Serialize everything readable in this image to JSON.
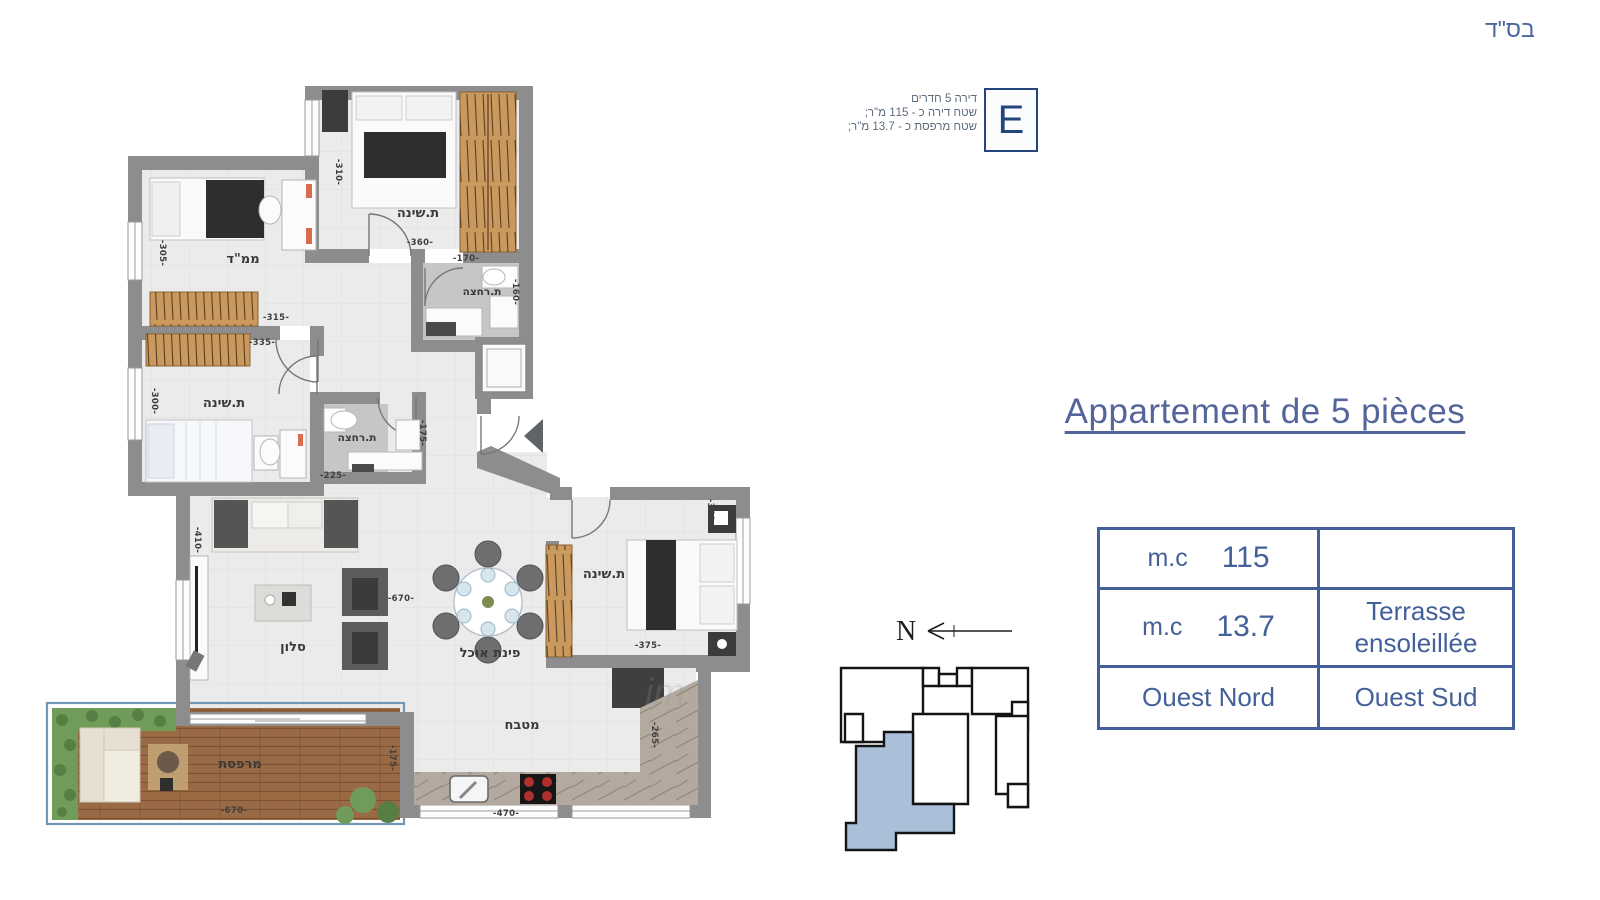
{
  "header": {
    "bsd": "בס\"ד"
  },
  "unit_info": {
    "letter": "E",
    "lines": [
      "דירה 5 חדרים",
      "שטח דירה כ - 115 מ\"ר;",
      "שטח מרפסת כ - 13.7 מ\"ר;"
    ]
  },
  "title": {
    "text": "Appartement de 5 pièces"
  },
  "spec_table": {
    "rows": [
      {
        "left": {
          "label": "m.c",
          "value": "115"
        },
        "right": ""
      },
      {
        "left": {
          "label": "m.c",
          "value": "13.7"
        },
        "right": "Terrasse ensoleillée"
      },
      {
        "left": {
          "label": "",
          "value": "Ouest Nord"
        },
        "right": "Ouest Sud"
      }
    ]
  },
  "compass": {
    "label": "N"
  },
  "watermark": "im",
  "colors": {
    "accent_blue": "#44609a",
    "deep_blue": "#25457d",
    "wall_gray": "#8d8d8d",
    "floor": "#ebebeb",
    "wood": "#c9995e",
    "deck": "#9a6a45",
    "hedge": "#6f9c58",
    "keyplan_highlight": "#a9c0d8",
    "dim_text": "#3f3f3f"
  },
  "floor_plan": {
    "room_labels": [
      {
        "text": "ת.שינה",
        "x": 418,
        "y": 217
      },
      {
        "text": "ממ\"ד",
        "x": 243,
        "y": 263
      },
      {
        "text": "ת.רחצה",
        "x": 482,
        "y": 295,
        "size": 10.5
      },
      {
        "text": "ת.שינה",
        "x": 224,
        "y": 407
      },
      {
        "text": "ת.רחצה",
        "x": 357,
        "y": 441,
        "size": 10.5
      },
      {
        "text": "סלון",
        "x": 293,
        "y": 651
      },
      {
        "text": "פינת אוכל",
        "x": 490,
        "y": 657
      },
      {
        "text": "ת.שינה",
        "x": 604,
        "y": 578
      },
      {
        "text": "מטבח",
        "x": 522,
        "y": 729
      },
      {
        "text": "מרפסת",
        "x": 240,
        "y": 768
      }
    ],
    "dimensions": [
      {
        "text": "-310-",
        "x": 336,
        "y": 172,
        "rot": 90
      },
      {
        "text": "-360-",
        "x": 420,
        "y": 245
      },
      {
        "text": "-305-",
        "x": 160,
        "y": 253,
        "rot": 90
      },
      {
        "text": "-315-",
        "x": 276,
        "y": 320
      },
      {
        "text": "-335-",
        "x": 262,
        "y": 345
      },
      {
        "text": "-300-",
        "x": 152,
        "y": 401,
        "rot": 90
      },
      {
        "text": "-170-",
        "x": 466,
        "y": 261
      },
      {
        "text": "-160-",
        "x": 513,
        "y": 292,
        "rot": 90
      },
      {
        "text": "-225-",
        "x": 333,
        "y": 478
      },
      {
        "text": "-175-",
        "x": 420,
        "y": 433,
        "rot": 90
      },
      {
        "text": "-410-",
        "x": 195,
        "y": 540,
        "rot": 90
      },
      {
        "text": "-670-",
        "x": 401,
        "y": 601
      },
      {
        "text": "-340-",
        "x": 708,
        "y": 512,
        "rot": 90
      },
      {
        "text": "-375-",
        "x": 648,
        "y": 648
      },
      {
        "text": "-265-",
        "x": 652,
        "y": 735,
        "rot": 90
      },
      {
        "text": "-470-",
        "x": 506,
        "y": 816
      },
      {
        "text": "-670-",
        "x": 234,
        "y": 813
      },
      {
        "text": "-175-",
        "x": 390,
        "y": 758,
        "rot": 90
      }
    ]
  }
}
